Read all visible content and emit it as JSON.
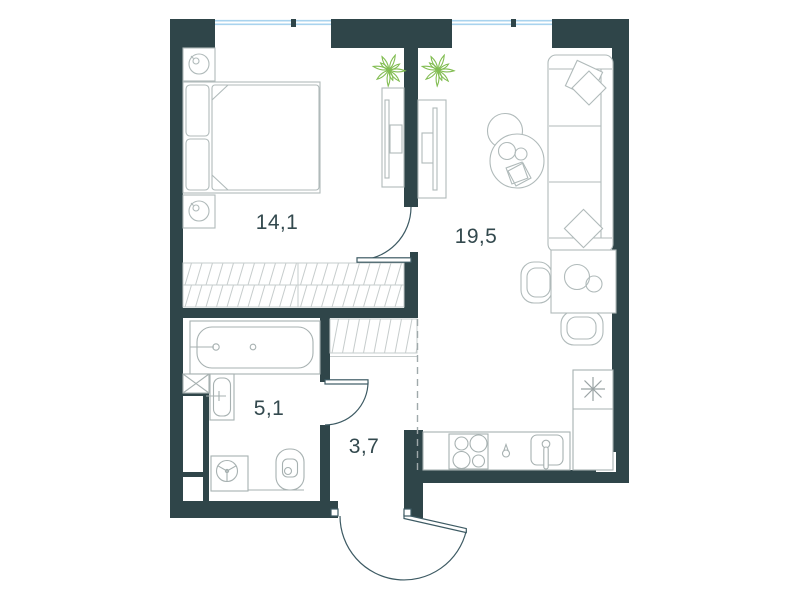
{
  "plan": {
    "type": "apartment-floor-plan",
    "rooms": [
      {
        "name": "bedroom",
        "area": "14,1"
      },
      {
        "name": "living-room-kitchen",
        "area": "19,5"
      },
      {
        "name": "bathroom",
        "area": "5,1"
      },
      {
        "name": "hallway",
        "area": "3,7"
      }
    ],
    "windows": 2,
    "doors": [
      "bedroom-door",
      "bathroom-door",
      "entrance-door"
    ],
    "wardrobes": [
      "bedroom-wardrobe",
      "hallway-closet"
    ],
    "icons": [
      "plant-icon",
      "snowflake-icon"
    ],
    "colors": {
      "wall": "#2f4549",
      "window_glazing": "#a9d3ee",
      "furniture_outline": "#b0baba",
      "hatch_line": "#c6cccc",
      "door_line": "#3d5a63",
      "plant_green": "#82bd52",
      "label_text": "#33494e",
      "background": "#ffffff"
    }
  }
}
